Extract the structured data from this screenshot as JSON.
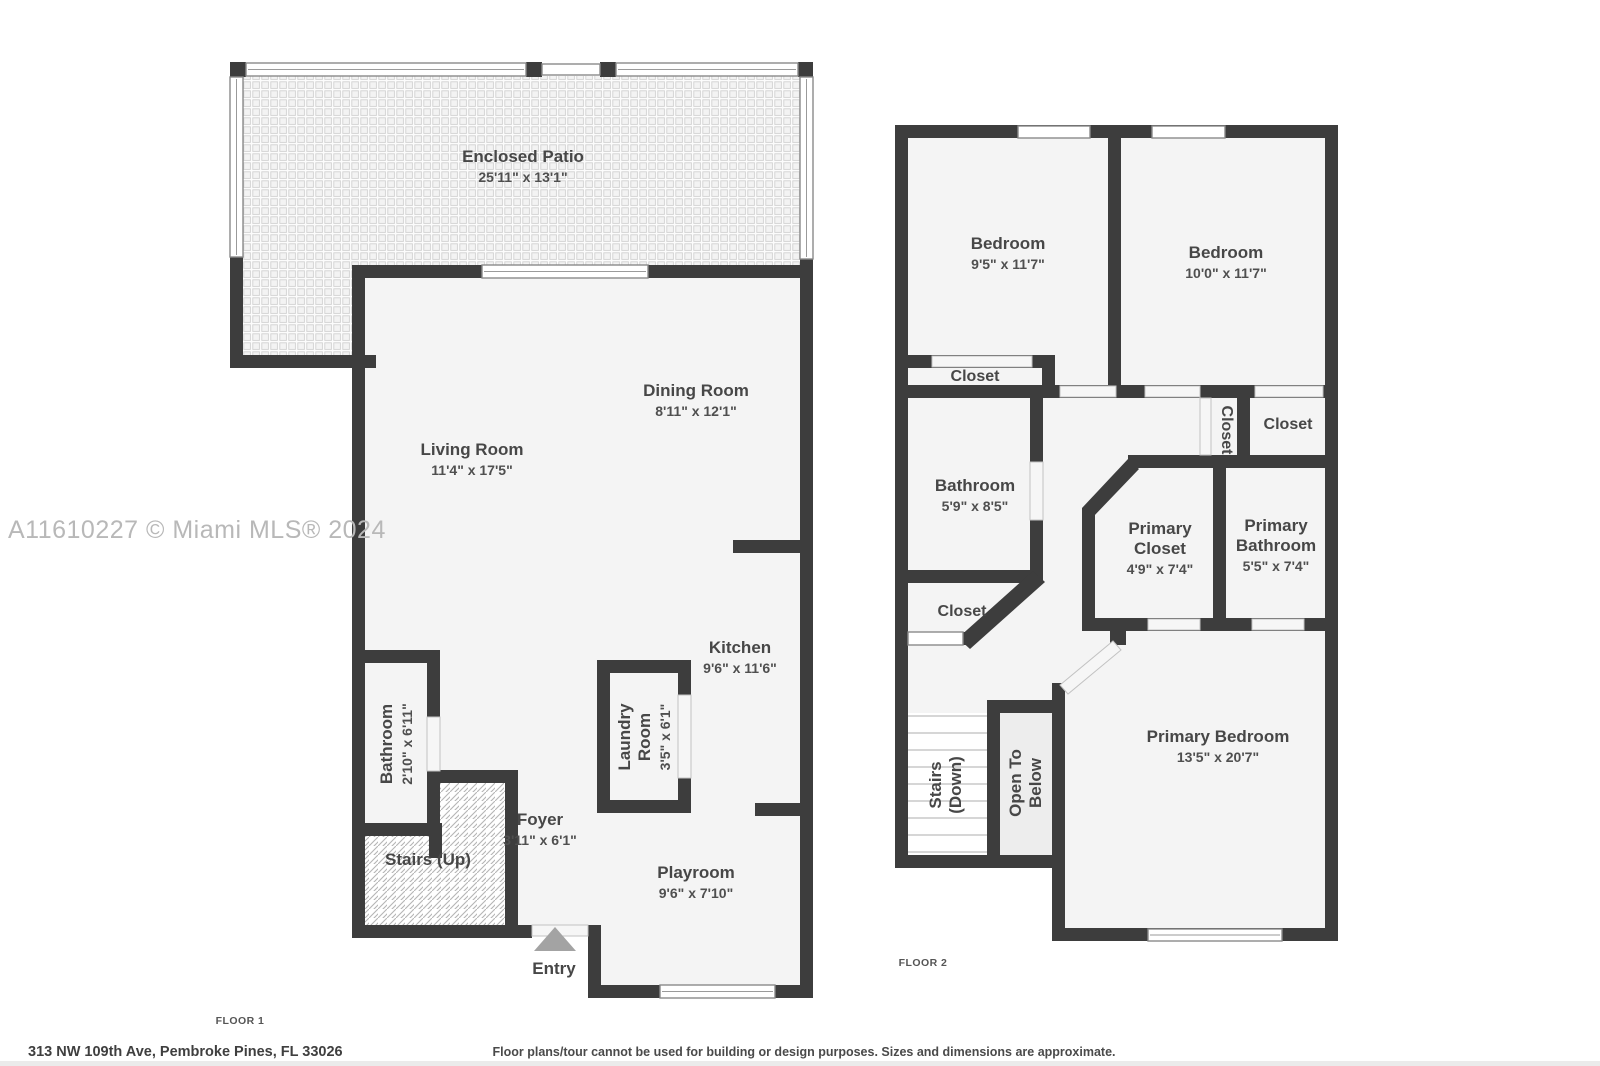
{
  "watermark": "A11610227 © Miami MLS® 2024",
  "address": "313 NW 109th Ave, Pembroke Pines, FL 33026",
  "disclaimer": "Floor plans/tour cannot be used for building or design purposes. Sizes and dimensions are approximate.",
  "colors": {
    "wall": "#3d3d3d",
    "floor_fill": "#f4f4f4",
    "open_to_below_fill": "#ededed",
    "label_text": "#474747",
    "watermark_text": "#b8b8b8",
    "entry_arrow": "#a3a3a3"
  },
  "floor1": {
    "label": "FLOOR 1",
    "rooms": [
      {
        "id": "enclosed-patio",
        "name": "Enclosed Patio",
        "dims": "25'11\" x 13'1\""
      },
      {
        "id": "living-room",
        "name": "Living Room",
        "dims": "11'4\" x 17'5\""
      },
      {
        "id": "dining-room",
        "name": "Dining Room",
        "dims": "8'11\" x 12'1\""
      },
      {
        "id": "kitchen",
        "name": "Kitchen",
        "dims": "9'6\" x 11'6\""
      },
      {
        "id": "laundry-room",
        "name": "Laundry Room",
        "dims": "3'5\" x 6'1\""
      },
      {
        "id": "bathroom",
        "name": "Bathroom",
        "dims": "2'10\" x 6'11\""
      },
      {
        "id": "stairs-up",
        "name": "Stairs (Up)"
      },
      {
        "id": "foyer",
        "name": "Foyer",
        "dims": "3'11\" x 6'1\""
      },
      {
        "id": "playroom",
        "name": "Playroom",
        "dims": "9'6\" x 7'10\""
      },
      {
        "id": "entry",
        "name": "Entry"
      }
    ]
  },
  "floor2": {
    "label": "FLOOR 2",
    "rooms": [
      {
        "id": "bedroom-left",
        "name": "Bedroom",
        "dims": "9'5\" x 11'7\""
      },
      {
        "id": "bedroom-right",
        "name": "Bedroom",
        "dims": "10'0\" x 11'7\""
      },
      {
        "id": "closet-bedroom-left",
        "name": "Closet"
      },
      {
        "id": "bathroom",
        "name": "Bathroom",
        "dims": "5'9\" x 8'5\""
      },
      {
        "id": "closet-hall",
        "name": "Closet"
      },
      {
        "id": "closet-bedroom-right",
        "name": "Closet"
      },
      {
        "id": "primary-closet",
        "name": "Primary Closet",
        "dims": "4'9\" x 7'4\""
      },
      {
        "id": "primary-bathroom",
        "name": "Primary Bathroom",
        "dims": "5'5\" x 7'4\""
      },
      {
        "id": "closet-bathroom",
        "name": "Closet"
      },
      {
        "id": "stairs-down",
        "name": "Stairs (Down)"
      },
      {
        "id": "open-to-below",
        "name": "Open To Below"
      },
      {
        "id": "primary-bedroom",
        "name": "Primary Bedroom",
        "dims": "13'5\" x 20'7\""
      }
    ]
  }
}
